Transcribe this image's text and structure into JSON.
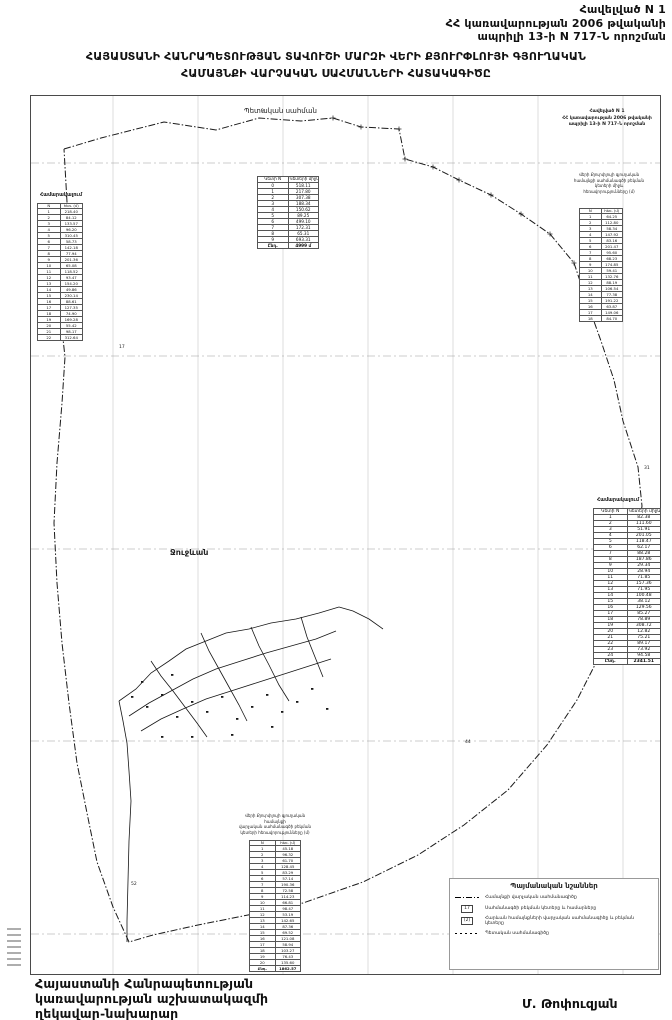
{
  "page": {
    "appendix": {
      "line1": "Հավելված N 1",
      "line2": "ՀՀ կառավարության 2006 թվականի",
      "line3": "ապրիլի 13-ի N 717-Ն որոշման"
    },
    "title": {
      "line1": "ՀԱՅԱՍՏԱՆԻ ՀԱՆՐԱՊԵՏՈՒԹՅԱՆ ՏԱՎՈՒՇԻ ՄԱՐԶԻ ՎԵՐԻ ՔՅՈՒՐՓԼՈՒՅԻ ԳՅՈՒՂԱԿԱՆ",
      "line2": "ՀԱՄԱՅՆՔԻ ՎԱՐՉԱԿԱՆ ՍԱՀՄԱՆՆԵՐԻ ՀԱՏԱԿԱԳԻԾԸ"
    },
    "signature": {
      "line1": "Հայաստանի Հանրապետության",
      "line2": "կառավարության աշխատակազմի",
      "line3": "ղեկավար-նախարար",
      "name": "Մ. Թոփուզյան"
    }
  },
  "map": {
    "labels": {
      "state_border": "Պետական սահման",
      "village": "Ջուջևան"
    },
    "stamp": {
      "line1": "Հավելված N 1",
      "line2": "ՀՀ կառավարության 2006 թվականի",
      "line3": "ապրիլի 13-ի N 717-Ն որոշման"
    },
    "stamp_caption": [
      "Վերի Քյուրփլույի գյուղական",
      "համայնքի սահմանագծի բեկման",
      "կետերի միջև",
      "հեռավորությունները (մ)"
    ],
    "bottom_caption": [
      "Վերի Քյուրփլույի գյուղական համայնքի",
      "վարչական սահմանագծի բեկման",
      "կետերի հեռավորությունները (մ)"
    ],
    "colors": {
      "ink": "#1a1a1a",
      "street": "#161616",
      "grid": "#c6c6c6",
      "graticule": "#9a9a9a"
    },
    "grid": {
      "vx": [
        82,
        167,
        252,
        337,
        422,
        507,
        592
      ],
      "hy": [
        67,
        260,
        453,
        645,
        838
      ]
    },
    "boundary": [
      [
        33,
        53
      ],
      [
        70,
        42
      ],
      [
        133,
        26
      ],
      [
        185,
        34
      ],
      [
        228,
        22
      ],
      [
        270,
        25
      ],
      [
        302,
        22
      ],
      [
        330,
        31
      ],
      [
        368,
        33
      ],
      [
        374,
        63
      ],
      [
        402,
        71
      ],
      [
        428,
        84
      ],
      [
        460,
        99
      ],
      [
        490,
        118
      ],
      [
        519,
        138
      ],
      [
        543,
        167
      ],
      [
        555,
        203
      ],
      [
        570,
        245
      ],
      [
        583,
        284
      ],
      [
        592,
        325
      ],
      [
        607,
        371
      ],
      [
        611,
        410
      ],
      [
        603,
        463
      ],
      [
        589,
        513
      ],
      [
        571,
        555
      ],
      [
        546,
        604
      ],
      [
        516,
        649
      ],
      [
        477,
        694
      ],
      [
        433,
        729
      ],
      [
        387,
        759
      ],
      [
        332,
        786
      ],
      [
        272,
        807
      ],
      [
        217,
        819
      ],
      [
        167,
        829
      ],
      [
        122,
        839
      ],
      [
        98,
        846
      ],
      [
        82,
        811
      ],
      [
        66,
        766
      ],
      [
        56,
        717
      ],
      [
        46,
        667
      ],
      [
        38,
        607
      ],
      [
        31,
        547
      ],
      [
        26,
        487
      ],
      [
        23,
        427
      ],
      [
        26,
        367
      ],
      [
        31,
        307
      ],
      [
        34,
        261
      ],
      [
        28,
        206
      ],
      [
        31,
        156
      ],
      [
        36,
        106
      ],
      [
        33,
        53
      ]
    ],
    "crosses": [
      [
        302,
        22
      ],
      [
        330,
        31
      ],
      [
        368,
        33
      ],
      [
        374,
        63
      ],
      [
        402,
        71
      ],
      [
        428,
        84
      ],
      [
        460,
        99
      ],
      [
        490,
        118
      ],
      [
        519,
        138
      ],
      [
        543,
        167
      ]
    ],
    "streets": [
      [
        [
          88,
          605
        ],
        [
          105,
          593
        ],
        [
          120,
          577
        ],
        [
          138,
          565
        ],
        [
          155,
          553
        ],
        [
          175,
          545
        ],
        [
          195,
          537
        ],
        [
          218,
          533
        ],
        [
          240,
          527
        ],
        [
          265,
          523
        ],
        [
          288,
          517
        ],
        [
          308,
          511
        ]
      ],
      [
        [
          98,
          620
        ],
        [
          118,
          607
        ],
        [
          140,
          595
        ],
        [
          162,
          583
        ],
        [
          185,
          573
        ],
        [
          210,
          565
        ],
        [
          235,
          557
        ],
        [
          260,
          550
        ],
        [
          285,
          543
        ],
        [
          305,
          535
        ]
      ],
      [
        [
          110,
          635
        ],
        [
          130,
          623
        ],
        [
          152,
          613
        ],
        [
          175,
          603
        ],
        [
          200,
          595
        ],
        [
          225,
          587
        ],
        [
          250,
          579
        ],
        [
          275,
          571
        ],
        [
          300,
          563
        ]
      ],
      [
        [
          120,
          565
        ],
        [
          130,
          580
        ],
        [
          142,
          595
        ],
        [
          154,
          611
        ],
        [
          166,
          627
        ],
        [
          176,
          641
        ]
      ],
      [
        [
          170,
          537
        ],
        [
          178,
          555
        ],
        [
          188,
          573
        ],
        [
          198,
          591
        ],
        [
          208,
          609
        ],
        [
          216,
          625
        ]
      ],
      [
        [
          220,
          531
        ],
        [
          228,
          550
        ],
        [
          238,
          569
        ],
        [
          248,
          589
        ],
        [
          258,
          605
        ]
      ],
      [
        [
          270,
          521
        ],
        [
          276,
          541
        ],
        [
          284,
          561
        ],
        [
          292,
          581
        ]
      ],
      [
        [
          88,
          605
        ],
        [
          92,
          625
        ],
        [
          96,
          647
        ],
        [
          98,
          675
        ],
        [
          100,
          705
        ],
        [
          98,
          745
        ],
        [
          97,
          785
        ],
        [
          96,
          825
        ],
        [
          96,
          846
        ]
      ],
      [
        [
          308,
          511
        ],
        [
          322,
          515
        ],
        [
          338,
          523
        ],
        [
          352,
          533
        ]
      ]
    ],
    "blocks": [
      [
        100,
        600
      ],
      [
        115,
        610
      ],
      [
        130,
        598
      ],
      [
        145,
        620
      ],
      [
        160,
        605
      ],
      [
        175,
        615
      ],
      [
        190,
        600
      ],
      [
        205,
        622
      ],
      [
        220,
        610
      ],
      [
        235,
        598
      ],
      [
        250,
        615
      ],
      [
        265,
        605
      ],
      [
        280,
        592
      ],
      [
        295,
        612
      ],
      [
        130,
        640
      ],
      [
        160,
        640
      ],
      [
        200,
        638
      ],
      [
        240,
        630
      ],
      [
        110,
        585
      ],
      [
        140,
        578
      ]
    ],
    "point_labels": [
      {
        "n": "9",
        "x": 230,
        "y": 14
      },
      {
        "n": "12",
        "x": 36,
        "y": 199
      },
      {
        "n": "17",
        "x": 88,
        "y": 250
      },
      {
        "n": "23",
        "x": 558,
        "y": 207
      },
      {
        "n": "31",
        "x": 613,
        "y": 371
      },
      {
        "n": "44",
        "x": 434,
        "y": 645
      },
      {
        "n": "52",
        "x": 100,
        "y": 787
      }
    ]
  },
  "tables": {
    "left": {
      "label": "Համարակալում",
      "col1": "N",
      "col2": "հեռ. (մ)",
      "rows": [
        [
          "1",
          "218.40"
        ],
        [
          "2",
          "84.12"
        ],
        [
          "3",
          "133.57"
        ],
        [
          "4",
          "96.20"
        ],
        [
          "5",
          "310.45"
        ],
        [
          "6",
          "58.73"
        ],
        [
          "7",
          "142.18"
        ],
        [
          "8",
          "77.94"
        ],
        [
          "9",
          "201.36"
        ],
        [
          "10",
          "65.08"
        ],
        [
          "11",
          "118.52"
        ],
        [
          "12",
          "93.47"
        ],
        [
          "13",
          "154.20"
        ],
        [
          "14",
          "49.86"
        ],
        [
          "15",
          "230.14"
        ],
        [
          "16",
          "88.61"
        ],
        [
          "17",
          "127.35"
        ],
        [
          "18",
          "74.90"
        ],
        [
          "19",
          "169.28"
        ],
        [
          "20",
          "55.42"
        ],
        [
          "21",
          "98.17"
        ],
        [
          "22",
          "312.64"
        ]
      ]
    },
    "topCenter": {
      "col1": "Կետի N",
      "col2": "Կետերի միջև հեռավոր. (մ)",
      "rows": [
        [
          "0",
          "518.11"
        ],
        [
          "1",
          "217.80"
        ],
        [
          "2",
          "307.38"
        ],
        [
          "3",
          "188.34"
        ],
        [
          "4",
          "150.62"
        ],
        [
          "5",
          "89.25"
        ],
        [
          "6",
          "499.10"
        ],
        [
          "7",
          "172.31"
        ],
        [
          "8",
          "65.31"
        ],
        [
          "9",
          "693.31"
        ]
      ],
      "total": [
        "Ընդ.",
        "4999 մ"
      ]
    },
    "rightTop": {
      "col1": "N",
      "col2": "հեռ. (մ)",
      "rows": [
        [
          "1",
          "64.25"
        ],
        [
          "2",
          "112.80"
        ],
        [
          "3",
          "58.34"
        ],
        [
          "4",
          "147.92"
        ],
        [
          "5",
          "83.16"
        ],
        [
          "6",
          "201.47"
        ],
        [
          "7",
          "95.60"
        ],
        [
          "8",
          "68.23"
        ],
        [
          "9",
          "174.85"
        ],
        [
          "10",
          "59.41"
        ],
        [
          "11",
          "132.76"
        ],
        [
          "12",
          "88.19"
        ],
        [
          "13",
          "106.54"
        ],
        [
          "14",
          "77.38"
        ],
        [
          "15",
          "191.22"
        ],
        [
          "16",
          "63.87"
        ],
        [
          "17",
          "149.06"
        ],
        [
          "18",
          "84.70"
        ]
      ]
    },
    "rightMid": {
      "label": "Համարակալում",
      "col1": "Կետի N",
      "col2": "Կետերի միջև հեռավոր. (մ)",
      "rows": [
        [
          "1",
          "82.38"
        ],
        [
          "2",
          "111.60"
        ],
        [
          "3",
          "51.91"
        ],
        [
          "4",
          "201.05"
        ],
        [
          "5",
          "118.47"
        ],
        [
          "6",
          "62.17"
        ],
        [
          "7",
          "88.28"
        ],
        [
          "8",
          "187.86"
        ],
        [
          "9",
          "29.34"
        ],
        [
          "10",
          "28.94"
        ],
        [
          "11",
          "71.85"
        ],
        [
          "12",
          "157.36"
        ],
        [
          "13",
          "71.95"
        ],
        [
          "14",
          "100.48"
        ],
        [
          "15",
          "38.12"
        ],
        [
          "16",
          "129.56"
        ],
        [
          "17",
          "85.27"
        ],
        [
          "18",
          "78.89"
        ],
        [
          "19",
          "308.72"
        ],
        [
          "20",
          "12.82"
        ],
        [
          "21",
          "75.21"
        ],
        [
          "22",
          "89.17"
        ],
        [
          "23",
          "73.92"
        ],
        [
          "24",
          "94.58"
        ]
      ],
      "total": [
        "Ընդ.",
        "2341.51"
      ]
    },
    "bottomCenter": {
      "col1": "N",
      "col2": "հեռ. (մ)",
      "rows": [
        [
          "1",
          "45.18"
        ],
        [
          "2",
          "96.32"
        ],
        [
          "3",
          "61.70"
        ],
        [
          "4",
          "128.45"
        ],
        [
          "5",
          "83.29"
        ],
        [
          "6",
          "57.14"
        ],
        [
          "7",
          "190.36"
        ],
        [
          "8",
          "72.58"
        ],
        [
          "9",
          "114.23"
        ],
        [
          "10",
          "66.81"
        ],
        [
          "11",
          "98.47"
        ],
        [
          "12",
          "53.19"
        ],
        [
          "13",
          "142.65"
        ],
        [
          "14",
          "87.36"
        ],
        [
          "15",
          "69.52"
        ],
        [
          "16",
          "121.08"
        ],
        [
          "17",
          "58.94"
        ],
        [
          "18",
          "103.27"
        ],
        [
          "19",
          "76.43"
        ],
        [
          "20",
          "135.60"
        ]
      ],
      "total": [
        "Ընդ.",
        "1862.57"
      ]
    }
  },
  "legend": {
    "title": "Պայմանական նշաններ",
    "items": [
      {
        "symbol": "line-dashdot",
        "sample": "",
        "label": "Համայնքի վարչական սահմանագիծը"
      },
      {
        "symbol": "box",
        "sample": "17",
        "label": "Սահմանագծի բեկման կետերը և համարները"
      },
      {
        "symbol": "box",
        "sample": "(2)",
        "label": "Հարևան համայնքների վարչական սահմանագիծը և բեկման կետերը"
      },
      {
        "symbol": "line-dotted",
        "sample": "",
        "label": "Պետական սահմանագիծը"
      }
    ]
  }
}
